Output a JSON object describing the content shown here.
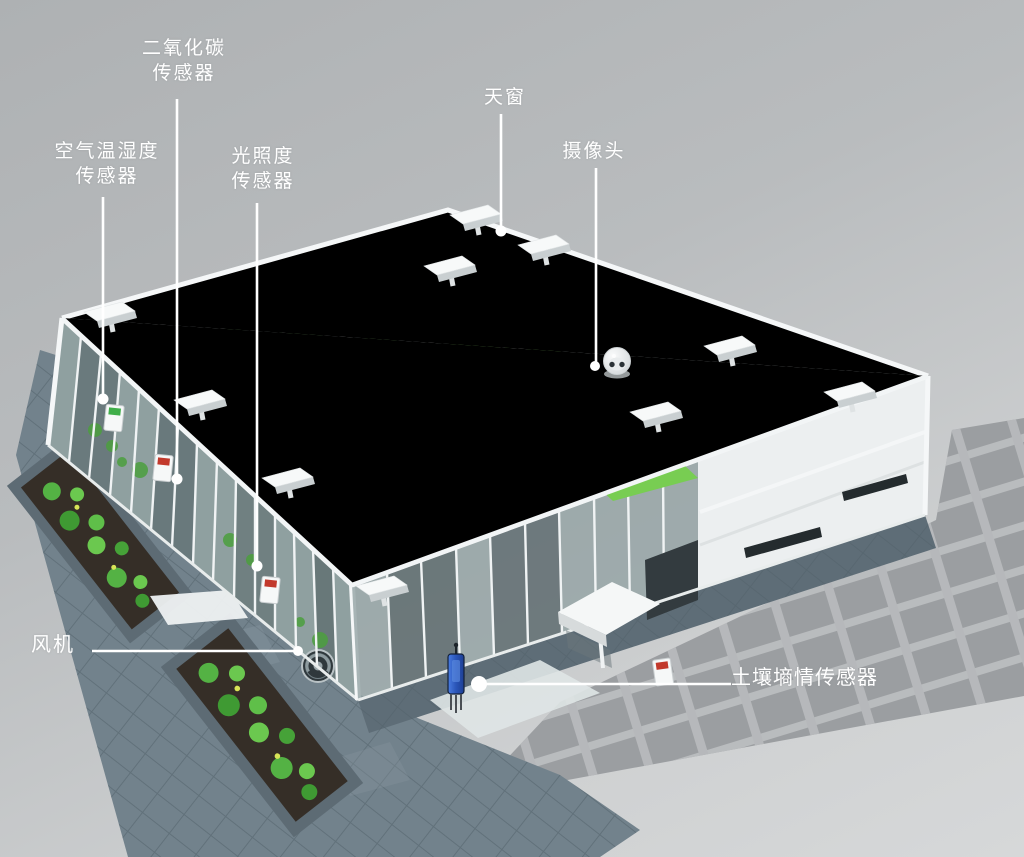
{
  "callouts": [
    {
      "id": "co2-sensor",
      "lines": [
        "二氧化碳",
        "传感器"
      ]
    },
    {
      "id": "air-temp-humidity-sensor",
      "lines": [
        "空气温湿度",
        "传感器"
      ]
    },
    {
      "id": "light-sensor",
      "lines": [
        "光照度",
        "传感器"
      ]
    },
    {
      "id": "skylight",
      "lines": [
        "天窗"
      ]
    },
    {
      "id": "camera",
      "lines": [
        "摄像头"
      ]
    },
    {
      "id": "fan",
      "lines": [
        "风机"
      ]
    },
    {
      "id": "soil-moisture-sensor",
      "lines": [
        "土壤墒情传感器"
      ]
    }
  ],
  "colors": {
    "background_top": "#aeb1b3",
    "background_bottom": "#d6d8d9",
    "label_text": "#ffffff",
    "leader_line": "#ffffff",
    "greenhouse_frame": "#f3f6f7",
    "roof_louver_gray": "#8d959b",
    "crop_green": "#5cb63e",
    "paving_slate": "#72828c",
    "garden_soil_brown": "#352e27",
    "cast_shadow_gray": "#9b9ea1",
    "soil_sensor_blue": "#2f5fc9",
    "sensor_tag_red": "#c2392c",
    "sensor_tag_green": "#3fae49"
  }
}
